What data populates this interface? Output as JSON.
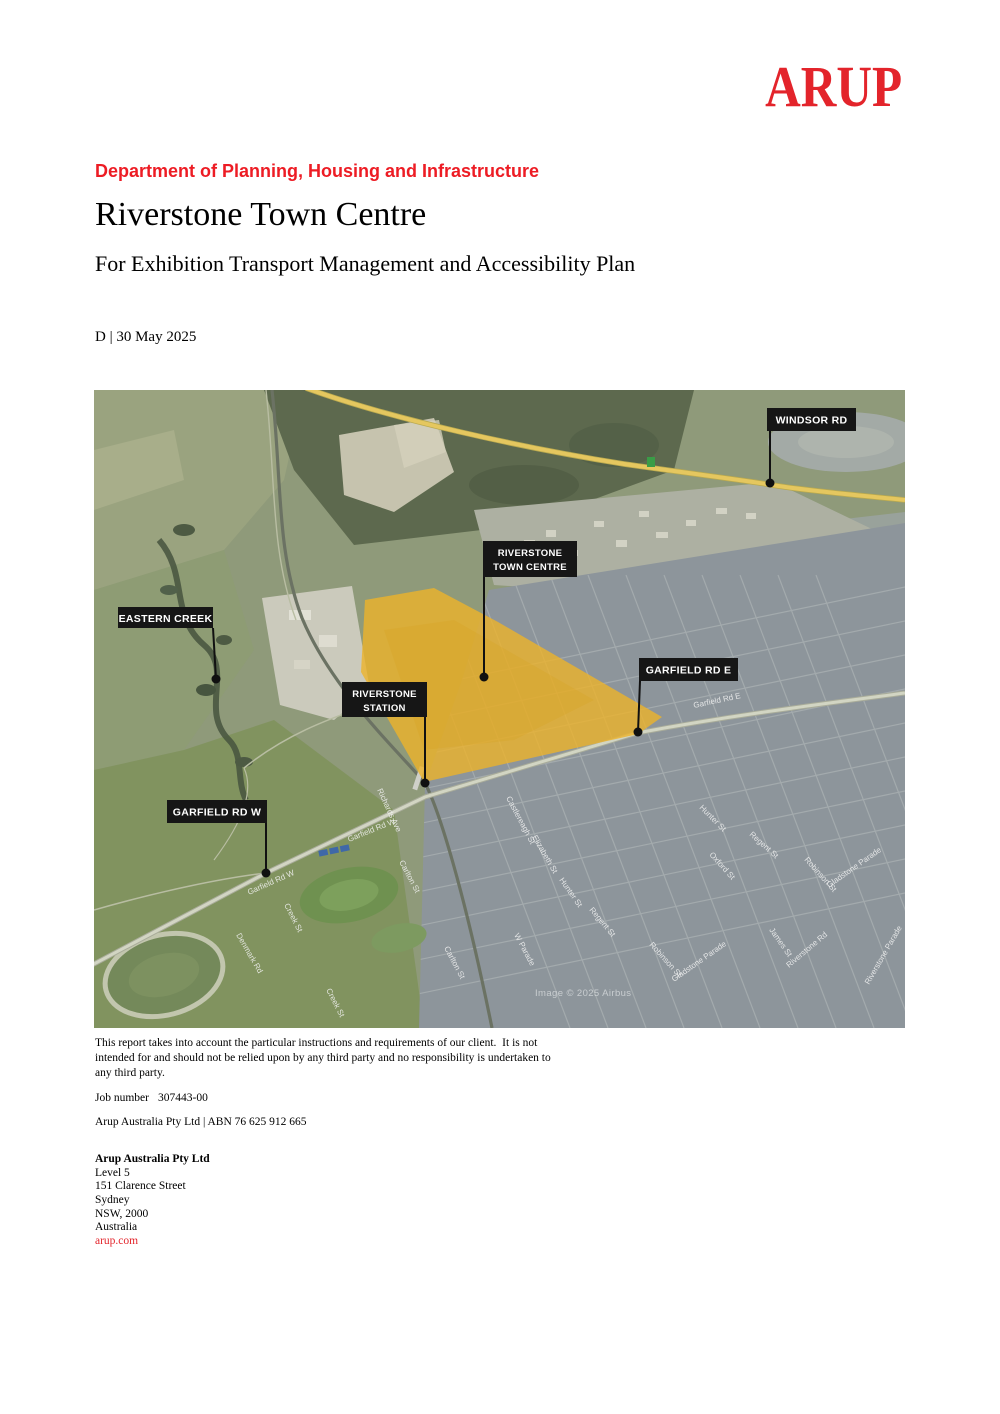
{
  "header": {
    "logo": "ARUP",
    "department": "Department of Planning, Housing and Infrastructure",
    "title": "Riverstone Town Centre",
    "subtitle": "For Exhibition Transport Management and Accessibility Plan",
    "revision_date": "D | 30 May 2025"
  },
  "map": {
    "callouts": {
      "windsor": "WINDSOR RD",
      "town_centre_line1": "RIVERSTONE",
      "town_centre_line2": "TOWN CENTRE",
      "eastern_creek": "EASTERN CREEK",
      "garfield_e": "GARFIELD RD E",
      "station_line1": "RIVERSTONE",
      "station_line2": "STATION",
      "garfield_w": "GARFIELD RD W"
    },
    "streets": [
      "Garfield Rd W",
      "Garfield Rd W",
      "Garfield Rd E",
      "Creek St",
      "Creek St",
      "Denmark Rd",
      "Carlton St",
      "Carlton St",
      "W Parade",
      "Castlereagh St",
      "Elizabeth St",
      "Hunter St",
      "Hunter St",
      "Regent St",
      "Regent St",
      "Oxford St",
      "Robinson St",
      "Robinson St",
      "James St",
      "Gladstone Parade",
      "Gladstone Parade",
      "Riverstone Rd",
      "Riverstone Parade",
      "Richards Ave"
    ],
    "attribution": "Image © 2025 Airbus",
    "highlight_color": "#ecb32b",
    "callout_bg": "#161616"
  },
  "footer": {
    "disclaimer": "This report takes into account the particular instructions and requirements of our client.  It is not intended for and should not be relied upon by any third party and no responsibility is undertaken to any third party.",
    "job_number_label": "Job number",
    "job_number": "307443-00",
    "company_line": "Arup Australia Pty Ltd | ABN 76 625 912 665",
    "address_name": "Arup Australia Pty Ltd",
    "address_lines": [
      "Level 5",
      "151 Clarence Street",
      "Sydney",
      "NSW, 2000",
      "Australia"
    ],
    "website": "arup.com"
  },
  "colors": {
    "arup_red": "#e3242b",
    "heading_red": "#ed1c24"
  }
}
